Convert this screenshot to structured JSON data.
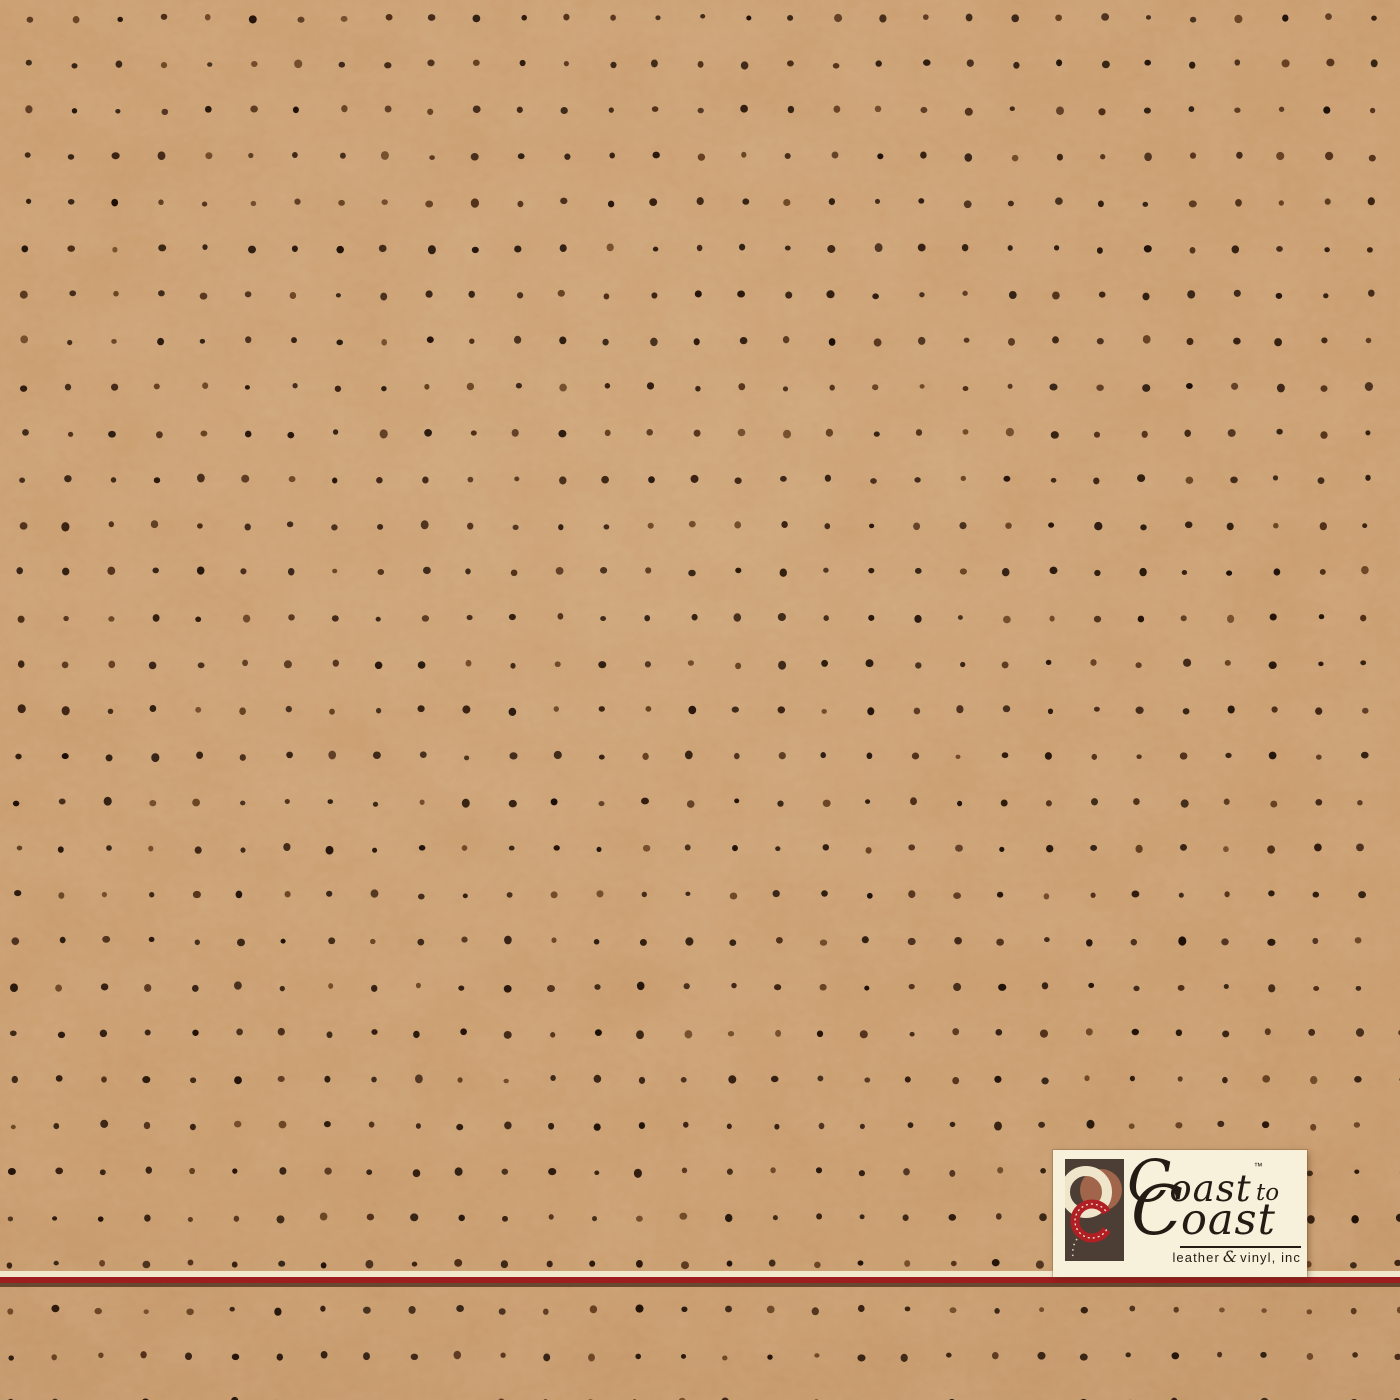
{
  "swatch": {
    "material": "perforated leather vinyl",
    "base_color": "#c08e5c",
    "dot_colors": [
      "#241309",
      "#2e1a0d",
      "#1d0f07",
      "#3a2112",
      "#4e2d17",
      "#654020"
    ],
    "grid": {
      "start_x": 30,
      "start_y": 18,
      "spacing_x": 44.8,
      "spacing_y": 46.15,
      "cols": 32,
      "rows": 31,
      "row_drift": -0.7,
      "dot_radius": 3.3,
      "jitter": 2.2,
      "seed": 987654321
    }
  },
  "divider": {
    "cream_color": "#f0e7cd",
    "red_color": "#9e1d1f",
    "shadow_color": "#553a24"
  },
  "logo": {
    "plate_color": "#f7f1db",
    "text_color": "#241c14",
    "line1_initial": "C",
    "line1_rest": "oast",
    "trademark": "™",
    "line1_suffix": "to",
    "line2_initial": "C",
    "line2_rest": "oast",
    "tagline_leather": "leather",
    "tagline_amp": "&",
    "tagline_rest": "vinyl, inc",
    "mark_colors": {
      "background": "#4c3e35",
      "cream_ring": "#efe5ca",
      "sienna_circle": "#a0654a",
      "red_ring": "#b01f24",
      "stitch": "#f3ead2"
    }
  }
}
